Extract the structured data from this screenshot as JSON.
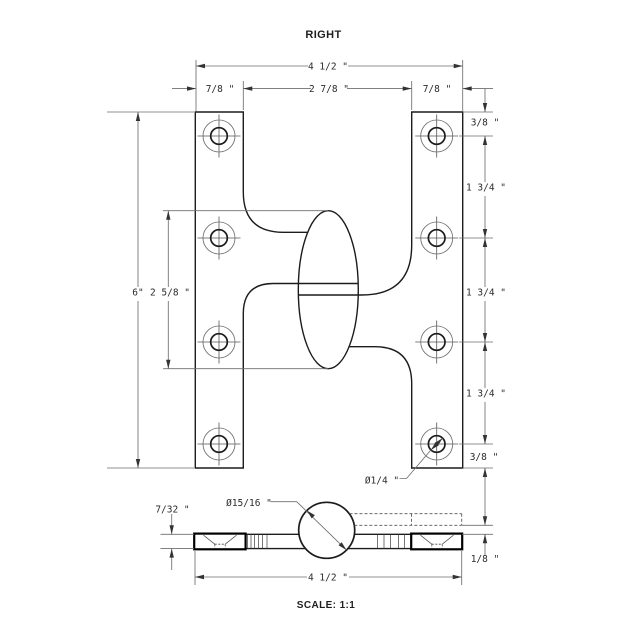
{
  "title": "RIGHT",
  "scale_label": "SCALE: 1:1",
  "front": {
    "overall_width": "4 1/2 \"",
    "left_edge": "7/8 \"",
    "center_span": "2 7/8 \"",
    "right_edge": "7/8 \"",
    "top_offset": "3/8 \"",
    "spacing1": "1 3/4 \"",
    "spacing2": "1 3/4 \"",
    "spacing3": "1 3/4 \"",
    "bottom_offset": "3/8 \"",
    "overall_height": "6\"",
    "knuckle_height": "2 5/8 \"",
    "hole_diameter": "Ø1/4 \""
  },
  "edge": {
    "knuckle_diameter": "Ø15/16 \"",
    "leaf_thickness": "7/32 \"",
    "leaf_offset": "1/8 \"",
    "overall_width": "4 1/2 \""
  },
  "colors": {
    "line": "#1c1c1c",
    "dimension": "#6e6e6e",
    "background": "#ffffff"
  }
}
